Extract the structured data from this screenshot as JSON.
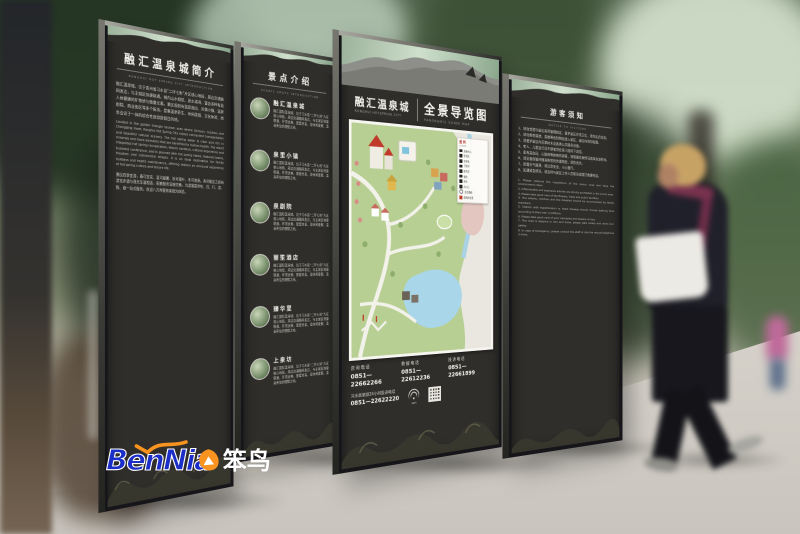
{
  "scene": {
    "description": "Outdoor wayfinding signage mockup for Ronghui Hot Spring City with a pedestrian walking past"
  },
  "logo": {
    "latin": "BenNia",
    "cn": "笨鸟"
  },
  "panel_intro": {
    "title": "融汇温泉城简介",
    "subtitle": "RONGHUI HOT SPRING CITY INTRODUCTION",
    "body_cn": "融汇温泉城，位于贵州省习水县“二环七射”片区核心地段，周边交通路网发达，与主城区快捷联通。城内山水相依、泉水清冽，富含多种有益人体健康的矿物质与微量元素。景区规划有温泉酒店、风情小镇、温泉剧院、商业街区等多个板块，是集温泉养生、休闲度假、文化体验、商务会议于一体的综合性旅游度假目的地。",
    "body_en": "Located in the golden triangle tourism area where Sichuan, Guizhou and Chongqing meet, Ronghui Hot Spring City enjoys convenient transportation and beautiful natural scenery. The hot spring water is clear and rich in minerals and trace elements that are beneficial to human health. The resort integrates hot spring recuperation, leisure vacation, cultural experience and business conference, and is planned with hot spring hotels, featured towns, theatres and commercial streets. It is an ideal destination for family holidays and health maintenance, offering visitors an all-round experience of hot spring culture and leisure life.",
    "body_cn2": "景区四季宜游，春可赏花、夏可避暑、秋可观叶、冬可泡泉。各功能区之间有游览步道与观光车道相连，配套服务设施完善，为游客提供吃、住、行、游、购、娱一站式服务，欢迎八方宾客前来观光体验。"
  },
  "panel_spots": {
    "title": "景点介绍",
    "subtitle": "SCENIC SPOTS INTRODUCTION",
    "items": [
      {
        "name": "融汇温泉城",
        "desc": "融汇国际温泉城，位于习水县“二环七射”片区核心地段，周边交通路网发达，与主城区快捷联通，环境优美，配套完善，是休闲度假、温泉养生的理想之地。"
      },
      {
        "name": "泉里小镇",
        "desc": "融汇国际温泉城，位于习水县“二环七射”片区核心地段，周边交通路网发达，与主城区快捷联通，环境优美，配套完善，是休闲度假、温泉养生的理想之地。"
      },
      {
        "name": "泉剧院",
        "desc": "融汇国际温泉城，位于习水县“二环七射”片区核心地段，周边交通路网发达，与主城区快捷联通，环境优美，配套完善，是休闲度假、温泉养生的理想之地。"
      },
      {
        "name": "丽笙酒店",
        "desc": "融汇国际温泉城，位于习水县“二环七射”片区核心地段，周边交通路网发达，与主城区快捷联通，环境优美，配套完善，是休闲度假、温泉养生的理想之地。"
      },
      {
        "name": "臻华里",
        "desc": "融汇国际温泉城，位于习水县“二环七射”片区核心地段，周边交通路网发达，与主城区快捷联通，环境优美，配套完善，是休闲度假、温泉养生的理想之地。"
      },
      {
        "name": "上泉坊",
        "desc": "融汇国际温泉城，位于习水县“二环七射”片区核心地段，周边交通路网发达，与主城区快捷联通，环境优美，配套完善，是休闲度假、温泉养生的理想之地。"
      }
    ]
  },
  "panel_map": {
    "brand_cn": "融汇温泉城",
    "brand_en": "RONGHUI HOTSPRING CITY",
    "title_cn": "全景导览图",
    "title_en": "PANORAMIC GUIDE MAP",
    "legend_title": "图例",
    "legend_sub": "LEGEND",
    "legend": [
      {
        "label": "游客中心"
      },
      {
        "label": "售票处"
      },
      {
        "label": "停车场"
      },
      {
        "label": "卫生间"
      },
      {
        "label": "医务室"
      },
      {
        "label": "餐饮"
      },
      {
        "label": "商店"
      },
      {
        "label": "出入口"
      },
      {
        "label": "游览路线"
      },
      {
        "label": "您所在位置"
      }
    ],
    "phones": [
      {
        "label": "咨询电话",
        "number": "0851—22662266"
      },
      {
        "label": "救援电话",
        "number": "0851—22612236"
      },
      {
        "label": "投诉电话",
        "number": "0851—22661899"
      }
    ],
    "hotline_label": "习水县旅游24小时投诉电话",
    "hotline_number": "0851—22622220",
    "wifi_label": "WiFi"
  },
  "panel_notice": {
    "title": "游客须知",
    "subtitle": "NOTICE TO VISITORS",
    "cn_lines": "1、请自觉遵守景区各项管理规定，爱护景区环境卫生，请勿乱扔垃圾。\n2、请勿携带易燃、易爆等危险物品进入景区，景区内请勿吸烟。\n3、请爱护景区内花草树木及各类公共服务设施。\n4、老人、儿童及行动不便者须在家人陪同下游览。\n5、患有高血压、心脏病等疾病的游客，请根据自身情况选择泡浴时间。\n6、请妥善保管好随身携带的贵重物品，谨防丢失。\n7、雨雪天气路滑，请注意安全，小心慢行。\n8、如遇紧急情况，请及时与景区工作人员联系或拨打救援电话。",
    "en_lines": "1. Please observe the regulations of the scenic area and keep the environment clean.\n2. Inflammable and explosive articles are strictly prohibited in the scenic area.\n3. Please take good care of the flowers, trees and public facilities.\n4. The elderly, children and the disabled should be accompanied by family members.\n5. Visitors with hypertension or heart disease should choose bathing time according to their own conditions.\n6. Please take good care of your valuables and beware of loss.\n7. The road is slippery in rain and snow, please walk slowly and mind your safety.\n8. In case of emergency, please contact the staff or dial the rescue telephone in time."
  }
}
